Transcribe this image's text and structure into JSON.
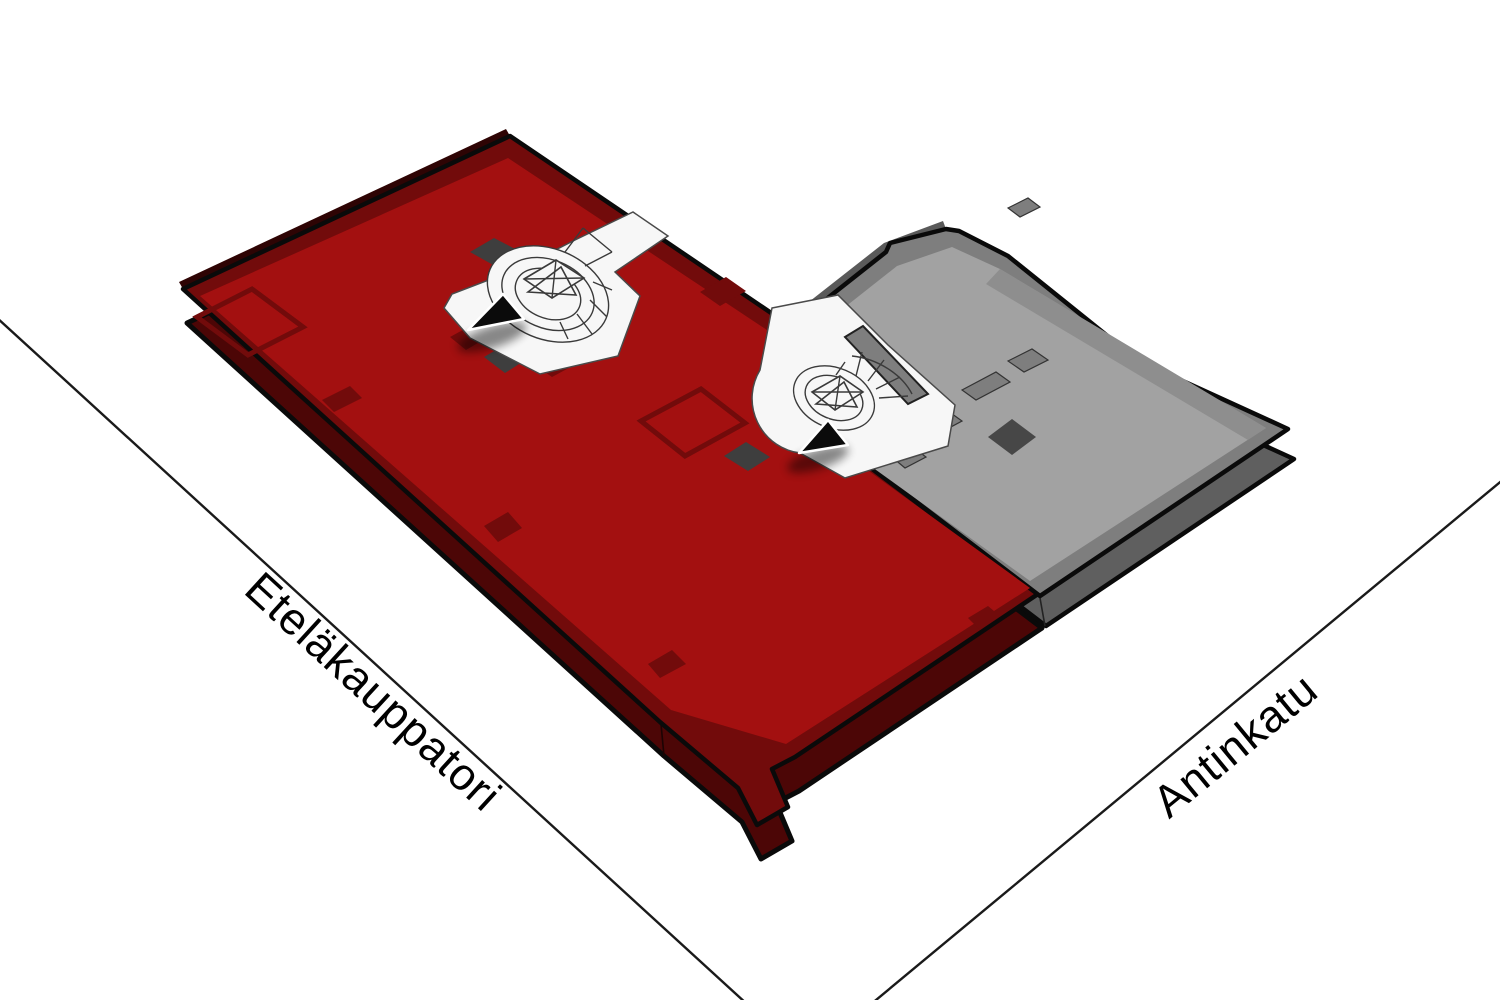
{
  "scene": {
    "description": "axonometric floor plan of a corner building between two streets",
    "background": "#ffffff"
  },
  "streets": [
    {
      "id": "etelakauppatori",
      "label": "Eteläkauppatori"
    },
    {
      "id": "antinkatu",
      "label": "Antinkatu"
    }
  ],
  "areas": [
    {
      "id": "highlighted-area",
      "color": "#A31010",
      "description": "red highlighted floor section"
    },
    {
      "id": "secondary-area",
      "color": "#A2A2A2",
      "description": "gray floor section"
    }
  ],
  "markers": [
    {
      "id": "stair-marker-1",
      "description": "black arrow marker at west stairwell"
    },
    {
      "id": "stair-marker-2",
      "description": "black arrow marker at central stairwell"
    }
  ],
  "colors": {
    "red-floor": "#A31010",
    "red-wall": "#720B0B",
    "red-side": "#4C0606",
    "red-sliver": "#2E0404",
    "gray-floor": "#A2A2A2",
    "gray-wall": "#7E7E7E",
    "gray-side": "#5F5F5F",
    "gray-sliver": "#5A5A5A",
    "shaft-dark": "#3E3E3E",
    "shaft-dark-gray": "#474747",
    "lobby-white": "#F7F7F7",
    "outline": "#0A0A0A",
    "street-line": "#1A1A1A",
    "label-text": "#000000"
  }
}
